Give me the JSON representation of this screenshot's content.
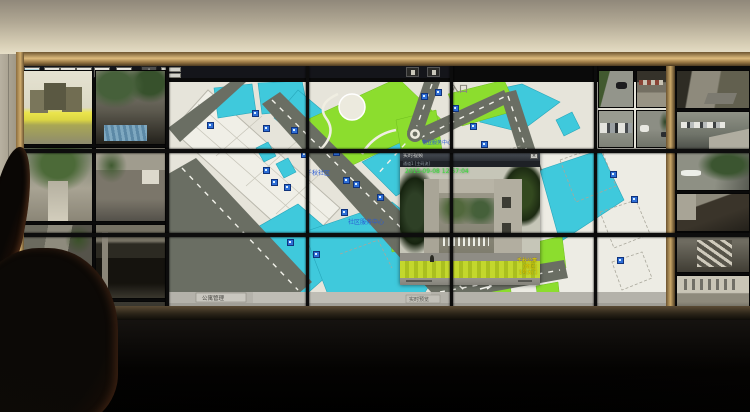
{
  "map": {
    "entrance_label": "入口",
    "community_label": "千秋社区",
    "service_center_label": "社区服务中心",
    "station_label": "物业服务中心",
    "status_left_button": "公寓管理",
    "status_right_button": "实时预览",
    "toolbar": {
      "buttons": [
        {
          "icon": "screen-layout-icon"
        },
        {
          "icon": "monitor-icon"
        },
        {
          "icon": "camera-icon"
        },
        {
          "icon": "display-icon"
        },
        {
          "icon": "pip-window-icon"
        },
        {
          "icon": "video-grid-icon"
        }
      ],
      "pan_glyph": "+"
    },
    "camera_marker_count": 26
  },
  "popup": {
    "title": "实时视频",
    "stream_info": "通道1 [主码流]",
    "timestamp": "2015-09-08 12:57:04",
    "close_glyph": "×",
    "osd_lines": [
      "千秋公寓",
      "(南区)",
      "1号大门"
    ]
  },
  "cameras": {
    "left_tiles": [
      {
        "scene": "entrance"
      },
      {
        "scene": "alleyfol"
      },
      {
        "scene": "courtyard"
      },
      {
        "scene": "sign"
      },
      {
        "scene": "alleycar"
      },
      {
        "scene": "garage"
      },
      {
        "scene": "garage2"
      },
      {
        "scene": "alleydark"
      }
    ],
    "right_a_tiles": [
      {
        "scene": "street"
      },
      {
        "scene": "shop"
      },
      {
        "scene": "parking"
      },
      {
        "scene": "streetcars"
      }
    ],
    "right_b_tiles": [
      {
        "scene": "shopstreet"
      },
      {
        "scene": "parkentry"
      },
      {
        "scene": "treestreet"
      },
      {
        "scene": "canopy"
      },
      {
        "scene": "stairs"
      },
      {
        "scene": "courtwhite"
      }
    ]
  },
  "colors": {
    "map_cyan": "#3fc9dc",
    "map_green": "#8cdd2e",
    "map_road": "#6a6e63",
    "accent_gold": "#c9a768",
    "osd_green": "#3ade3c",
    "osd_yellow": "#ecd800"
  }
}
